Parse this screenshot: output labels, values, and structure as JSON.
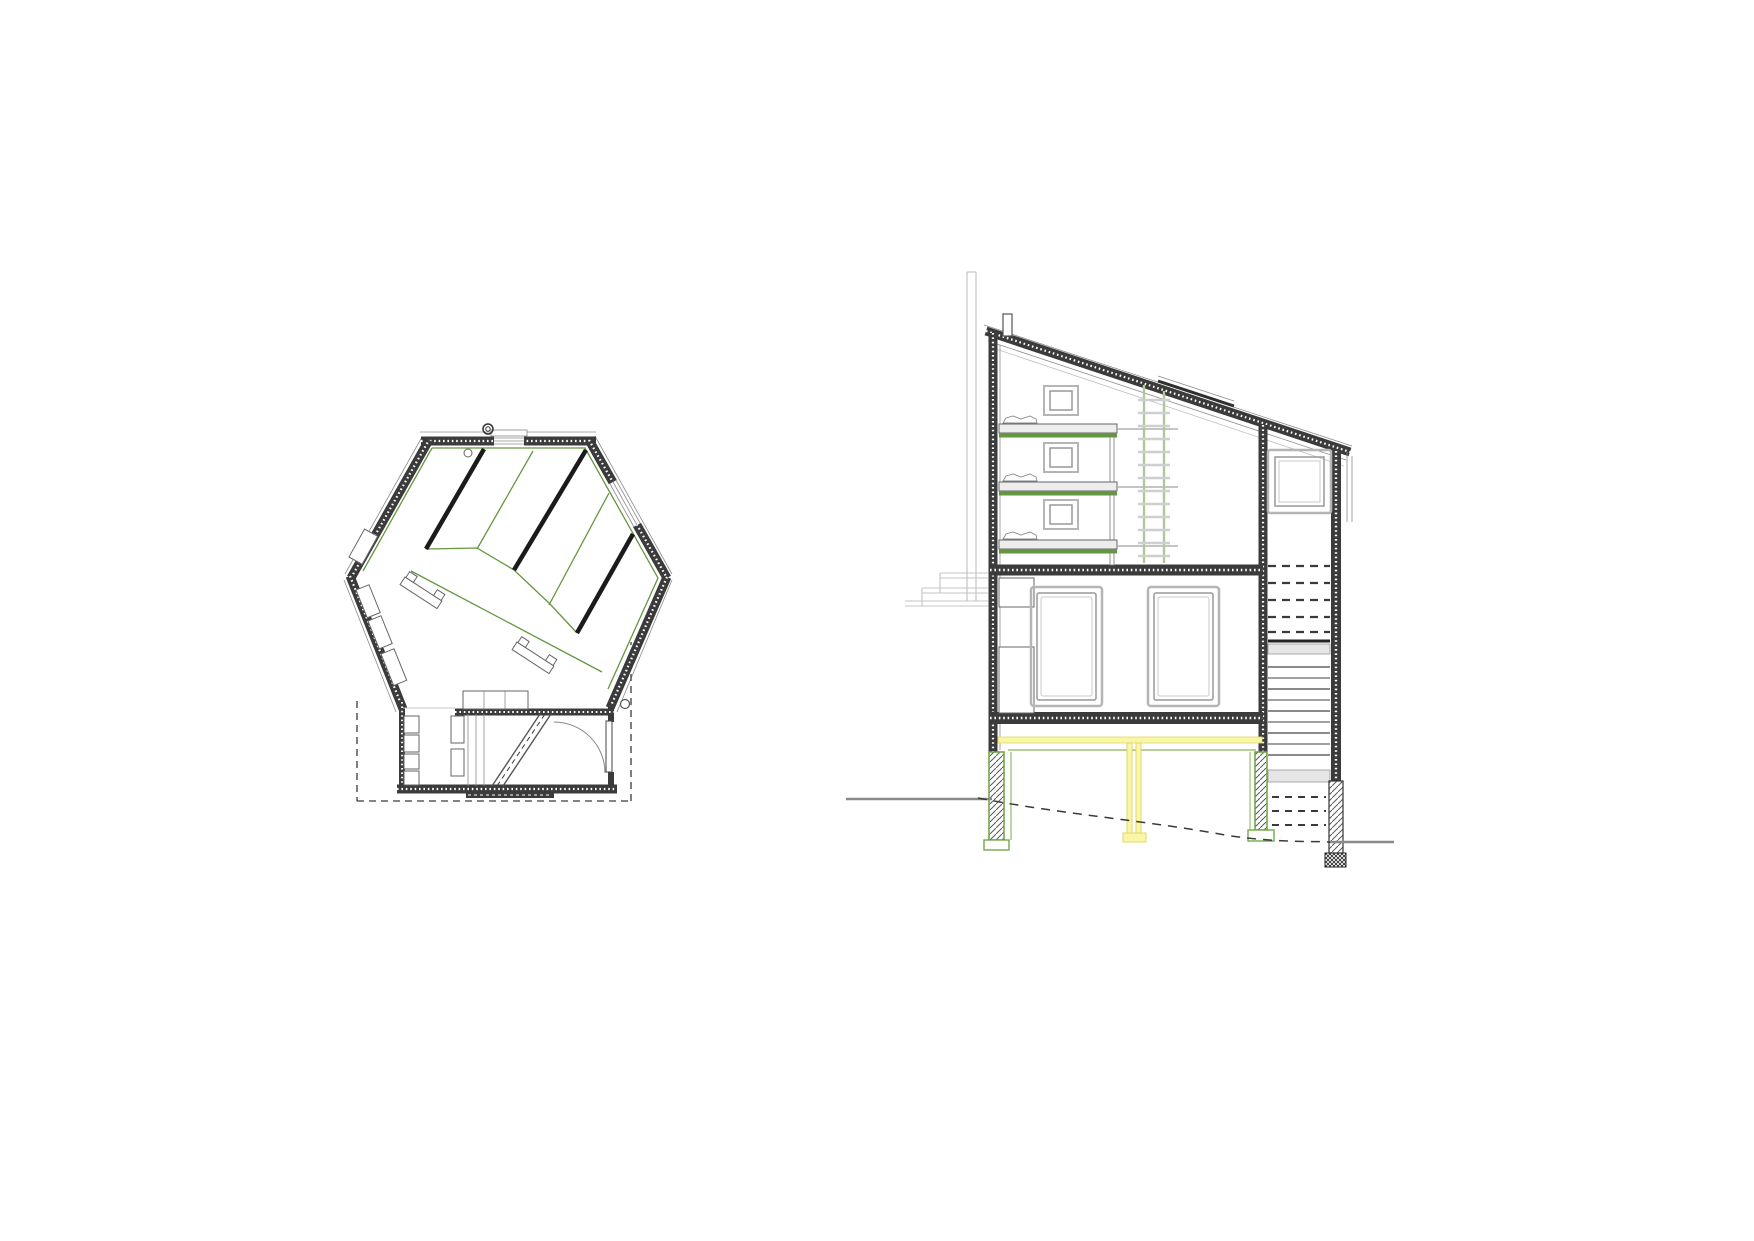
{
  "canvas": {
    "width": 1754,
    "height": 1241,
    "viewbox": "0 0 1754 1241",
    "background": "#ffffff"
  },
  "palette": {
    "bg": "#ffffff",
    "wall_dark": "#3b3b3b",
    "line_thin": "#8c8c8c",
    "line_light": "#c4c4c4",
    "partition_black": "#1b1b1b",
    "green_accent": "#639740",
    "green_light": "#9cc171",
    "ladder_green": "#b3c69a",
    "yellow_fill": "#faf6a8",
    "yellow_edge": "#e0d86a",
    "platform_fill": "#ededed",
    "landing_fill": "#e6e6e6",
    "hatch_line": "#5a5a5a",
    "pier_green": "#6aa23f",
    "dash_dark": "#3a3a3a",
    "ground_gray": "#8a8a8a"
  }
}
